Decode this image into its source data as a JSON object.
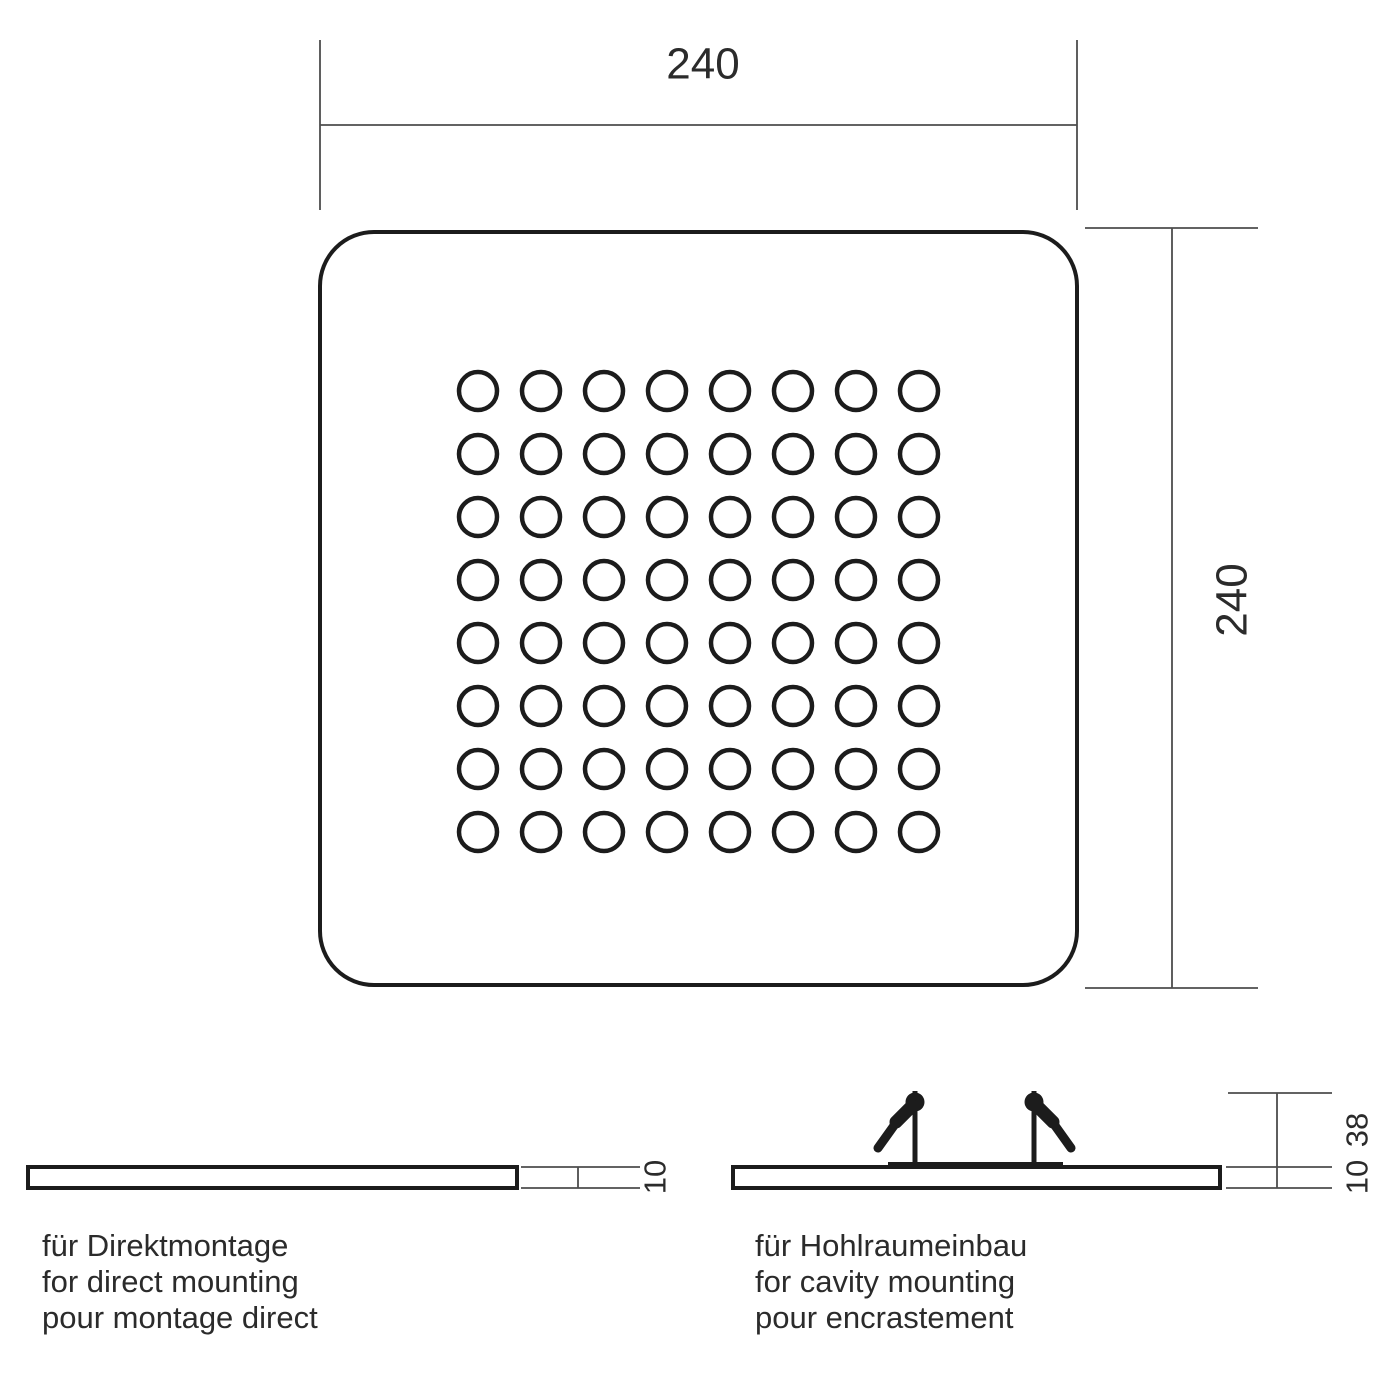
{
  "drawing": {
    "top_view": {
      "width_dim_label": "240",
      "height_dim_label": "240",
      "led_grid": {
        "rows": 8,
        "cols": 8
      }
    },
    "direct_mount": {
      "thickness_dim_label": "10",
      "caption_de": "für Direktmontage",
      "caption_en": "for direct mounting",
      "caption_fr": "pour montage direct"
    },
    "cavity_mount": {
      "clip_height_dim_label": "38",
      "thickness_dim_label": "10",
      "caption_de": "für Hohlraumeinbau",
      "caption_en": "for cavity mounting",
      "caption_fr": "pour encrastement"
    },
    "colors": {
      "outline": "#1c1c1c",
      "dim_line": "#4d4d4d",
      "text": "#2b2b2b",
      "background": "#ffffff"
    }
  }
}
